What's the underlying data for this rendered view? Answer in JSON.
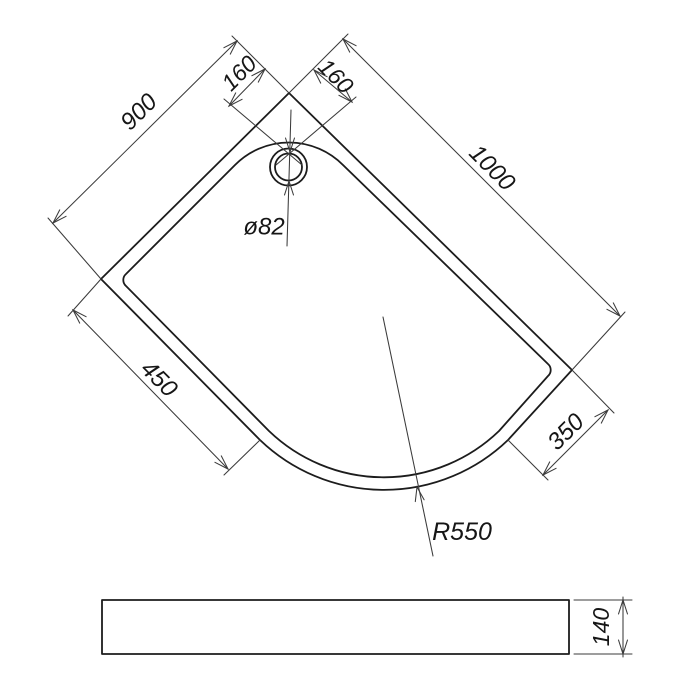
{
  "drawing": {
    "type": "technical-drawing-quadrant-shower-tray",
    "labels": {
      "offset_left": "160",
      "offset_right": "160",
      "side_left": "900",
      "side_right": "1000",
      "flat_bottom_left": "450",
      "flat_bottom_right": "350",
      "drain_diameter": "ø82",
      "corner_radius": "R550",
      "tray_height": "140"
    },
    "colors": {
      "outline": "#1c1c1c",
      "dimension_lines": "#3b3b3b",
      "background": "#ffffff"
    }
  }
}
